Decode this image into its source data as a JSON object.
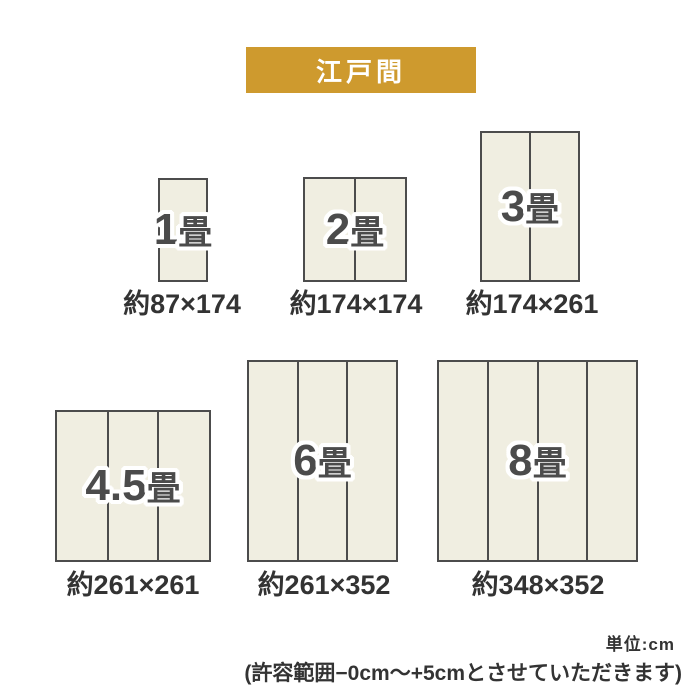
{
  "header": {
    "title": "江戸間"
  },
  "sizes": [
    {
      "number": "1",
      "unit": "畳",
      "dimensions": "約87×174",
      "panels": 1
    },
    {
      "number": "2",
      "unit": "畳",
      "dimensions": "約174×174",
      "panels": 2
    },
    {
      "number": "3",
      "unit": "畳",
      "dimensions": "約174×261",
      "panels": 2
    },
    {
      "number": "4.5",
      "unit": "畳",
      "dimensions": "約261×261",
      "panels": 3
    },
    {
      "number": "6",
      "unit": "畳",
      "dimensions": "約261×352",
      "panels": 3
    },
    {
      "number": "8",
      "unit": "畳",
      "dimensions": "約348×352",
      "panels": 4
    }
  ],
  "footer": {
    "unit_label": "単位:cm",
    "tolerance_note": "(許容範囲−0cm〜+5cmとさせていただきます)"
  },
  "colors": {
    "banner-bg": "#CE9A2E",
    "banner-text": "#FFFFFF",
    "mat-fill": "#F0EEE1",
    "mat-border": "#4C4C4C",
    "label-text": "#4B4B4B",
    "caption-text": "#333333",
    "page-bg": "#FFFFFF"
  }
}
